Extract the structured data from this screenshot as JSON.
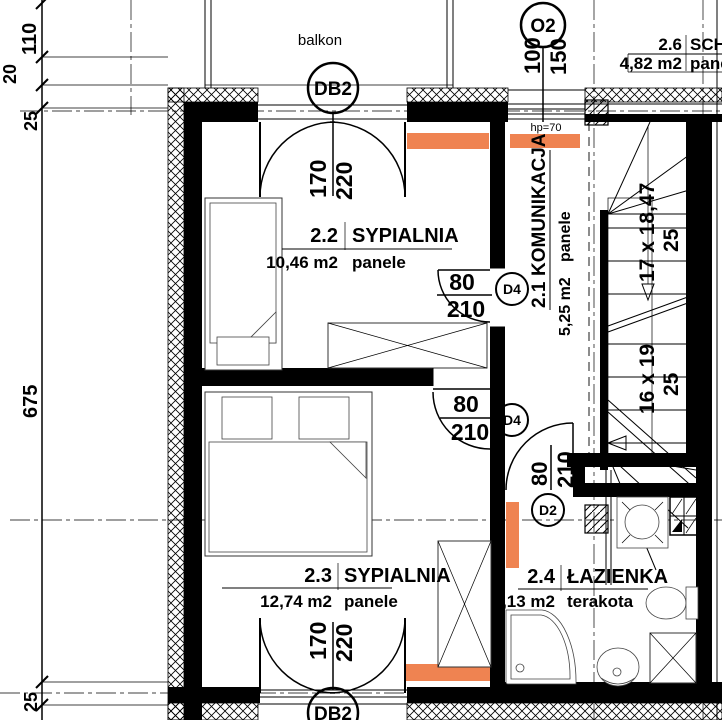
{
  "colors": {
    "radiator": "#EF8351",
    "line": "#000000",
    "background": "#FFFFFF"
  },
  "balcony": {
    "label": "balkon"
  },
  "rooms": {
    "komunikacja": {
      "number": "2.1",
      "name": "KOMUNIKACJA",
      "area": "5,25 m2",
      "floor": "panele"
    },
    "sypialnia22": {
      "number": "2.2",
      "name": "SYPIALNIA",
      "area": "10,46 m2",
      "floor": "panele"
    },
    "sypialnia23": {
      "number": "2.3",
      "name": "SYPIALNIA",
      "area": "12,74 m2",
      "floor": "panele"
    },
    "lazienka": {
      "number": "2.4",
      "name": "ŁAZIENKA",
      "area": "5,13 m2",
      "floor": "terakota"
    },
    "schowek": {
      "number": "2.6",
      "name": "SCH",
      "area": "4,82 m2",
      "floor": "pane"
    }
  },
  "openings": {
    "db2_top": {
      "tag": "DB2",
      "w": "170",
      "h": "220"
    },
    "db2_bottom": {
      "tag": "DB2",
      "w": "170",
      "h": "220"
    },
    "o2": {
      "tag": "O2",
      "w": "100",
      "h": "150"
    },
    "d4_upper": {
      "tag": "D4",
      "w": "80",
      "h": "210"
    },
    "d4_lower": {
      "tag": "D4",
      "w": "80",
      "h": "210"
    },
    "d2": {
      "tag": "D2",
      "w": "80",
      "h": "210"
    }
  },
  "stairs": {
    "flight_up": "17 x 18,47",
    "width_up": "25",
    "flight_down": "16 x 19",
    "width_down": "25"
  },
  "dimensions": {
    "d110": "110",
    "d20": "20",
    "d25top": "25",
    "d675": "675",
    "d25bottom": "25"
  },
  "annotations": {
    "sill_height": "hp=70"
  }
}
